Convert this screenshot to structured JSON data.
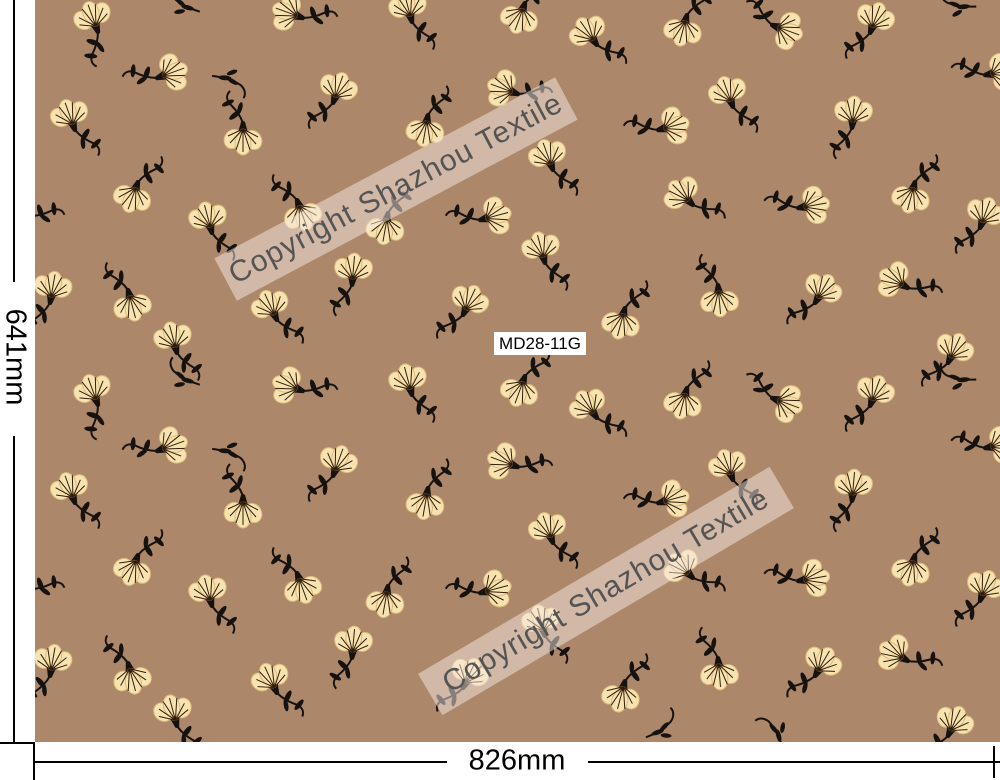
{
  "product": {
    "code": "MD28-11G"
  },
  "watermark": {
    "text": "Copyright Shazhou Textile",
    "text_color": "#545454",
    "band_color": "rgba(248,233,227,0.5)"
  },
  "dimensions": {
    "width_label": "826mm",
    "height_label": "641mm"
  },
  "colors": {
    "fabric_background": "#ac8769",
    "petal_fill": "#f7e3af",
    "petal_outline": "#dcb97c",
    "petal_veins": "#2f1d0c",
    "stem_and_leaves": "#151210",
    "margin_background": "#ffffff",
    "dimension_lines": "#000000"
  },
  "pattern": {
    "motif": "small cream fan-shaped flower with black calyx, curved black stem and leaves, scattered ditsy repeat",
    "flower_format": [
      "x",
      "y",
      "rotation_deg",
      "flip",
      "type(f=flower,s=stem-only)"
    ],
    "flowers": [
      [
        98,
        32,
        -20,
        1,
        "f"
      ],
      [
        180,
        4,
        160,
        0,
        "s"
      ],
      [
        303,
        18,
        -70,
        0,
        "f"
      ],
      [
        412,
        22,
        -15,
        0,
        "f"
      ],
      [
        157,
        78,
        70,
        1,
        "f"
      ],
      [
        233,
        80,
        -30,
        0,
        "s"
      ],
      [
        333,
        103,
        20,
        1,
        "f"
      ],
      [
        428,
        115,
        190,
        1,
        "f"
      ],
      [
        75,
        130,
        -20,
        0,
        "f"
      ],
      [
        138,
        182,
        200,
        1,
        "f"
      ],
      [
        243,
        123,
        180,
        0,
        "f"
      ],
      [
        297,
        200,
        160,
        0,
        "f"
      ],
      [
        212,
        233,
        -15,
        0,
        "f"
      ],
      [
        388,
        213,
        190,
        1,
        "f"
      ],
      [
        480,
        220,
        75,
        1,
        "f"
      ],
      [
        30,
        216,
        -70,
        0,
        "f"
      ],
      [
        128,
        290,
        165,
        0,
        "f"
      ],
      [
        277,
        320,
        -25,
        0,
        "f"
      ],
      [
        352,
        285,
        5,
        1,
        "f"
      ],
      [
        50,
        303,
        10,
        1,
        "f"
      ],
      [
        177,
        353,
        -15,
        0,
        "f"
      ],
      [
        463,
        315,
        25,
        1,
        "f"
      ],
      [
        525,
        3,
        200,
        1,
        "f"
      ],
      [
        687,
        15,
        195,
        1,
        "f"
      ],
      [
        772,
        25,
        110,
        1,
        "f"
      ],
      [
        870,
        33,
        20,
        1,
        "f"
      ],
      [
        597,
        45,
        -35,
        0,
        "f"
      ],
      [
        733,
        107,
        -20,
        0,
        "f"
      ],
      [
        658,
        130,
        75,
        1,
        "f"
      ],
      [
        852,
        128,
        5,
        1,
        "f"
      ],
      [
        553,
        170,
        -20,
        0,
        "f"
      ],
      [
        915,
        182,
        195,
        1,
        "f"
      ],
      [
        693,
        205,
        -45,
        0,
        "f"
      ],
      [
        798,
        208,
        80,
        1,
        "f"
      ],
      [
        980,
        228,
        20,
        1,
        "f"
      ],
      [
        545,
        263,
        -15,
        0,
        "f"
      ],
      [
        625,
        308,
        195,
        1,
        "f"
      ],
      [
        718,
        285,
        175,
        0,
        "f"
      ],
      [
        815,
        303,
        30,
        1,
        "f"
      ],
      [
        908,
        288,
        -60,
        0,
        "f"
      ],
      [
        948,
        363,
        25,
        1,
        "f"
      ],
      [
        518,
        94,
        -70,
        0,
        "f"
      ],
      [
        985,
        75,
        80,
        1,
        "f"
      ],
      [
        955,
        6,
        140,
        0,
        "s"
      ],
      [
        98,
        405,
        -20,
        1,
        "f"
      ],
      [
        180,
        377,
        160,
        0,
        "s"
      ],
      [
        303,
        391,
        -70,
        0,
        "f"
      ],
      [
        412,
        395,
        -15,
        0,
        "f"
      ],
      [
        157,
        451,
        70,
        1,
        "f"
      ],
      [
        233,
        453,
        -30,
        0,
        "s"
      ],
      [
        333,
        476,
        20,
        1,
        "f"
      ],
      [
        428,
        488,
        190,
        1,
        "f"
      ],
      [
        75,
        503,
        -20,
        0,
        "f"
      ],
      [
        138,
        555,
        200,
        1,
        "f"
      ],
      [
        243,
        496,
        180,
        0,
        "f"
      ],
      [
        297,
        573,
        160,
        0,
        "f"
      ],
      [
        212,
        606,
        -15,
        0,
        "f"
      ],
      [
        388,
        586,
        190,
        1,
        "f"
      ],
      [
        480,
        593,
        75,
        1,
        "f"
      ],
      [
        30,
        589,
        -70,
        0,
        "f"
      ],
      [
        128,
        663,
        165,
        0,
        "f"
      ],
      [
        277,
        693,
        -25,
        0,
        "f"
      ],
      [
        352,
        658,
        5,
        1,
        "f"
      ],
      [
        50,
        676,
        10,
        1,
        "f"
      ],
      [
        177,
        726,
        -15,
        0,
        "f"
      ],
      [
        463,
        688,
        25,
        1,
        "f"
      ],
      [
        525,
        376,
        200,
        1,
        "f"
      ],
      [
        687,
        388,
        195,
        1,
        "f"
      ],
      [
        772,
        398,
        110,
        1,
        "f"
      ],
      [
        870,
        406,
        20,
        1,
        "f"
      ],
      [
        597,
        418,
        -35,
        0,
        "f"
      ],
      [
        733,
        480,
        -20,
        0,
        "f"
      ],
      [
        658,
        503,
        75,
        1,
        "f"
      ],
      [
        852,
        501,
        5,
        1,
        "f"
      ],
      [
        553,
        543,
        -20,
        0,
        "f"
      ],
      [
        915,
        555,
        195,
        1,
        "f"
      ],
      [
        693,
        578,
        -45,
        0,
        "f"
      ],
      [
        798,
        581,
        80,
        1,
        "f"
      ],
      [
        980,
        601,
        20,
        1,
        "f"
      ],
      [
        545,
        636,
        -15,
        0,
        "f"
      ],
      [
        625,
        681,
        195,
        1,
        "f"
      ],
      [
        718,
        658,
        175,
        0,
        "f"
      ],
      [
        815,
        676,
        30,
        1,
        "f"
      ],
      [
        908,
        661,
        -60,
        0,
        "f"
      ],
      [
        948,
        736,
        25,
        1,
        "f"
      ],
      [
        518,
        467,
        -70,
        0,
        "f"
      ],
      [
        985,
        448,
        80,
        1,
        "f"
      ],
      [
        955,
        379,
        140,
        0,
        "s"
      ],
      [
        665,
        728,
        195,
        1,
        "s"
      ],
      [
        775,
        728,
        110,
        1,
        "s"
      ]
    ]
  }
}
